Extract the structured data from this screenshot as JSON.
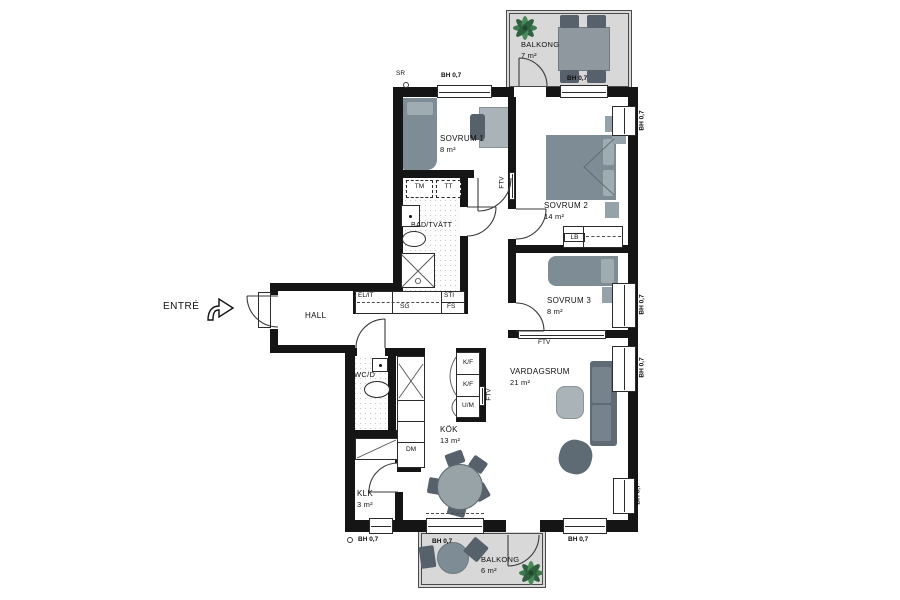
{
  "colors": {
    "wall": "#151515",
    "balcony_fill": "#d8d8d8",
    "furniture_dark": "#56616c",
    "furniture_mid": "#7e8d95",
    "furniture_light": "#a9b3b8",
    "plant_green": "#3d7a4c"
  },
  "entrance": {
    "label": "ENTRÉ"
  },
  "window_label": "BH 0,7",
  "misc": {
    "sr": "SR"
  },
  "rooms": [
    {
      "name": "SOVRUM 1",
      "area": "8 m²"
    },
    {
      "name": "SOVRUM 2",
      "area": "14 m²"
    },
    {
      "name": "SOVRUM 3",
      "area": "8 m²"
    },
    {
      "name": "BAD/TVÄTT",
      "area": ""
    },
    {
      "name": "HALL",
      "area": ""
    },
    {
      "name": "WC/D",
      "area": ""
    },
    {
      "name": "KÖK",
      "area": "13 m²"
    },
    {
      "name": "VARDAGSRUM",
      "area": "21 m²"
    },
    {
      "name": "KLK",
      "area": "3 m²"
    },
    {
      "name": "BALKONG",
      "area": "7 m²"
    },
    {
      "name": "BALKONG",
      "area": "6 m²"
    }
  ],
  "fixtures": {
    "tm": "TM",
    "tt": "TT",
    "lb": "LB",
    "kf": "K/F",
    "um": "U/M",
    "dm": "DM",
    "elit": "EL/IT",
    "sg": "SG",
    "sti": "STI",
    "fs": "FS",
    "ftv": "FTV"
  }
}
